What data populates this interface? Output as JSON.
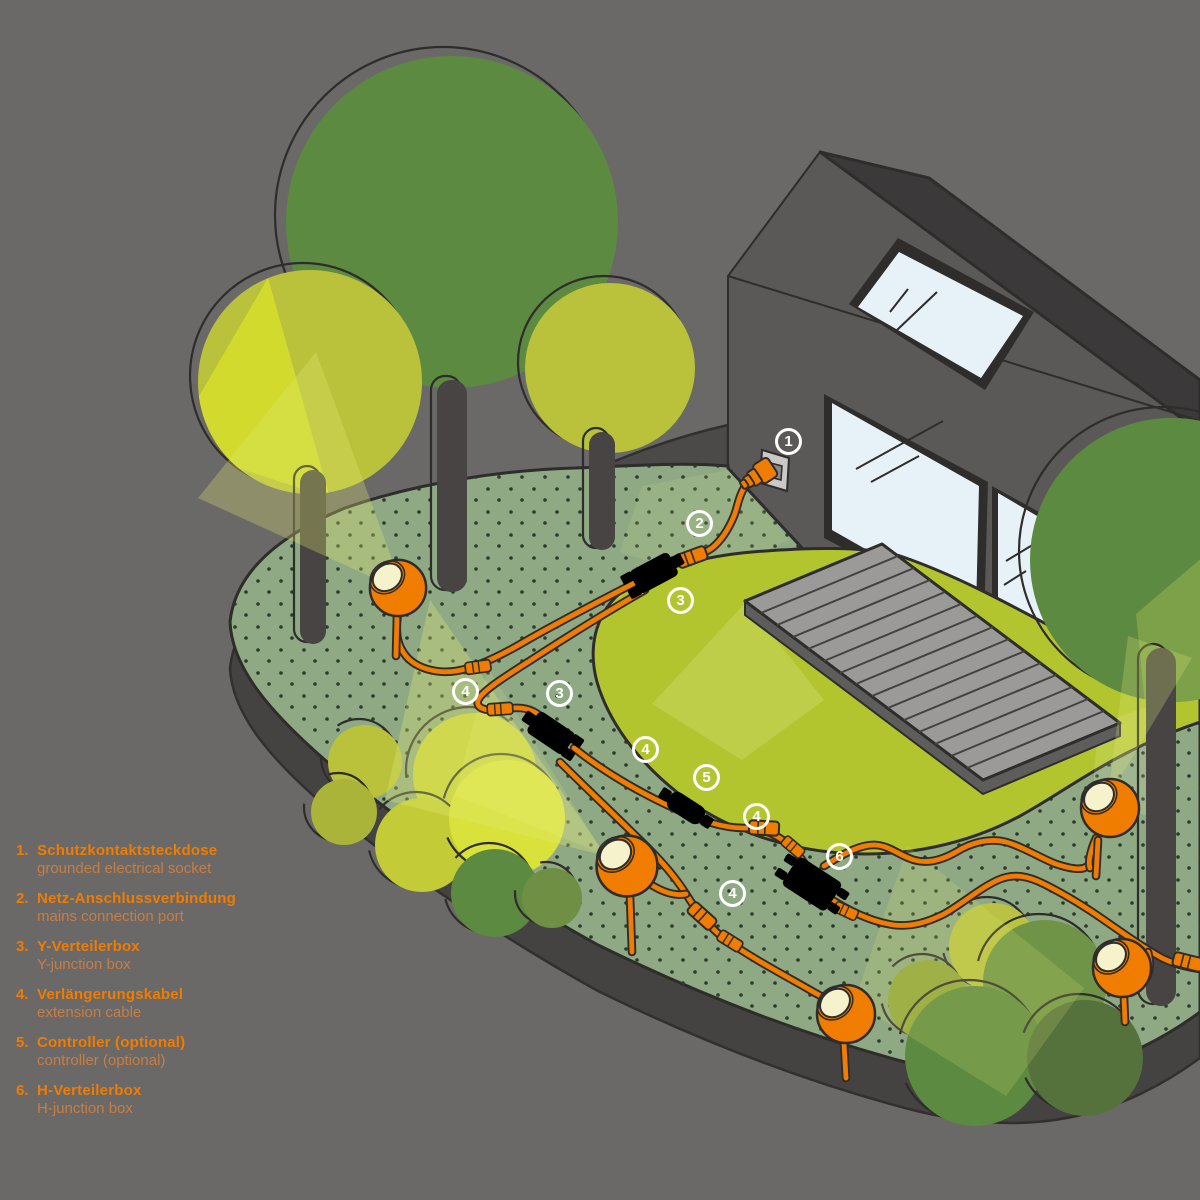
{
  "legend": {
    "items": [
      {
        "num": "1.",
        "de": "Schutzkontaktsteckdose",
        "en": "grounded electrical socket"
      },
      {
        "num": "2.",
        "de": "Netz-Anschlussverbindung",
        "en": "mains connection port"
      },
      {
        "num": "3.",
        "de": "Y-Verteilerbox",
        "en": "Y-junction box"
      },
      {
        "num": "4.",
        "de": "Verlängerungskabel",
        "en": "extension cable"
      },
      {
        "num": "5.",
        "de": "Controller (optional)",
        "en": "controller (optional)"
      },
      {
        "num": "6.",
        "de": "H-Verteilerbox",
        "en": "H-junction box"
      }
    ]
  },
  "badges": [
    {
      "label": "1"
    },
    {
      "label": "2"
    },
    {
      "label": "3"
    },
    {
      "label": "4"
    },
    {
      "label": "3"
    },
    {
      "label": "4"
    },
    {
      "label": "5"
    },
    {
      "label": "4"
    },
    {
      "label": "6"
    },
    {
      "label": "4"
    }
  ],
  "colors": {
    "background": "#6b6868",
    "accent_orange": "#f07c00",
    "legend_secondary_orange": "#c87e41",
    "ground_green": "#8ea983",
    "lawn_green": "#b2c52f",
    "tree_dark_green": "#5d8a41",
    "tree_light_green": "#b9c23a",
    "beam_yellow": "#d6df2b",
    "house_gray": "#5b5858",
    "roof_dark": "#3b3939",
    "window_blue": "#e7f2f8",
    "deck_gray": "#9c9a98",
    "badge_white": "#ffffff"
  }
}
